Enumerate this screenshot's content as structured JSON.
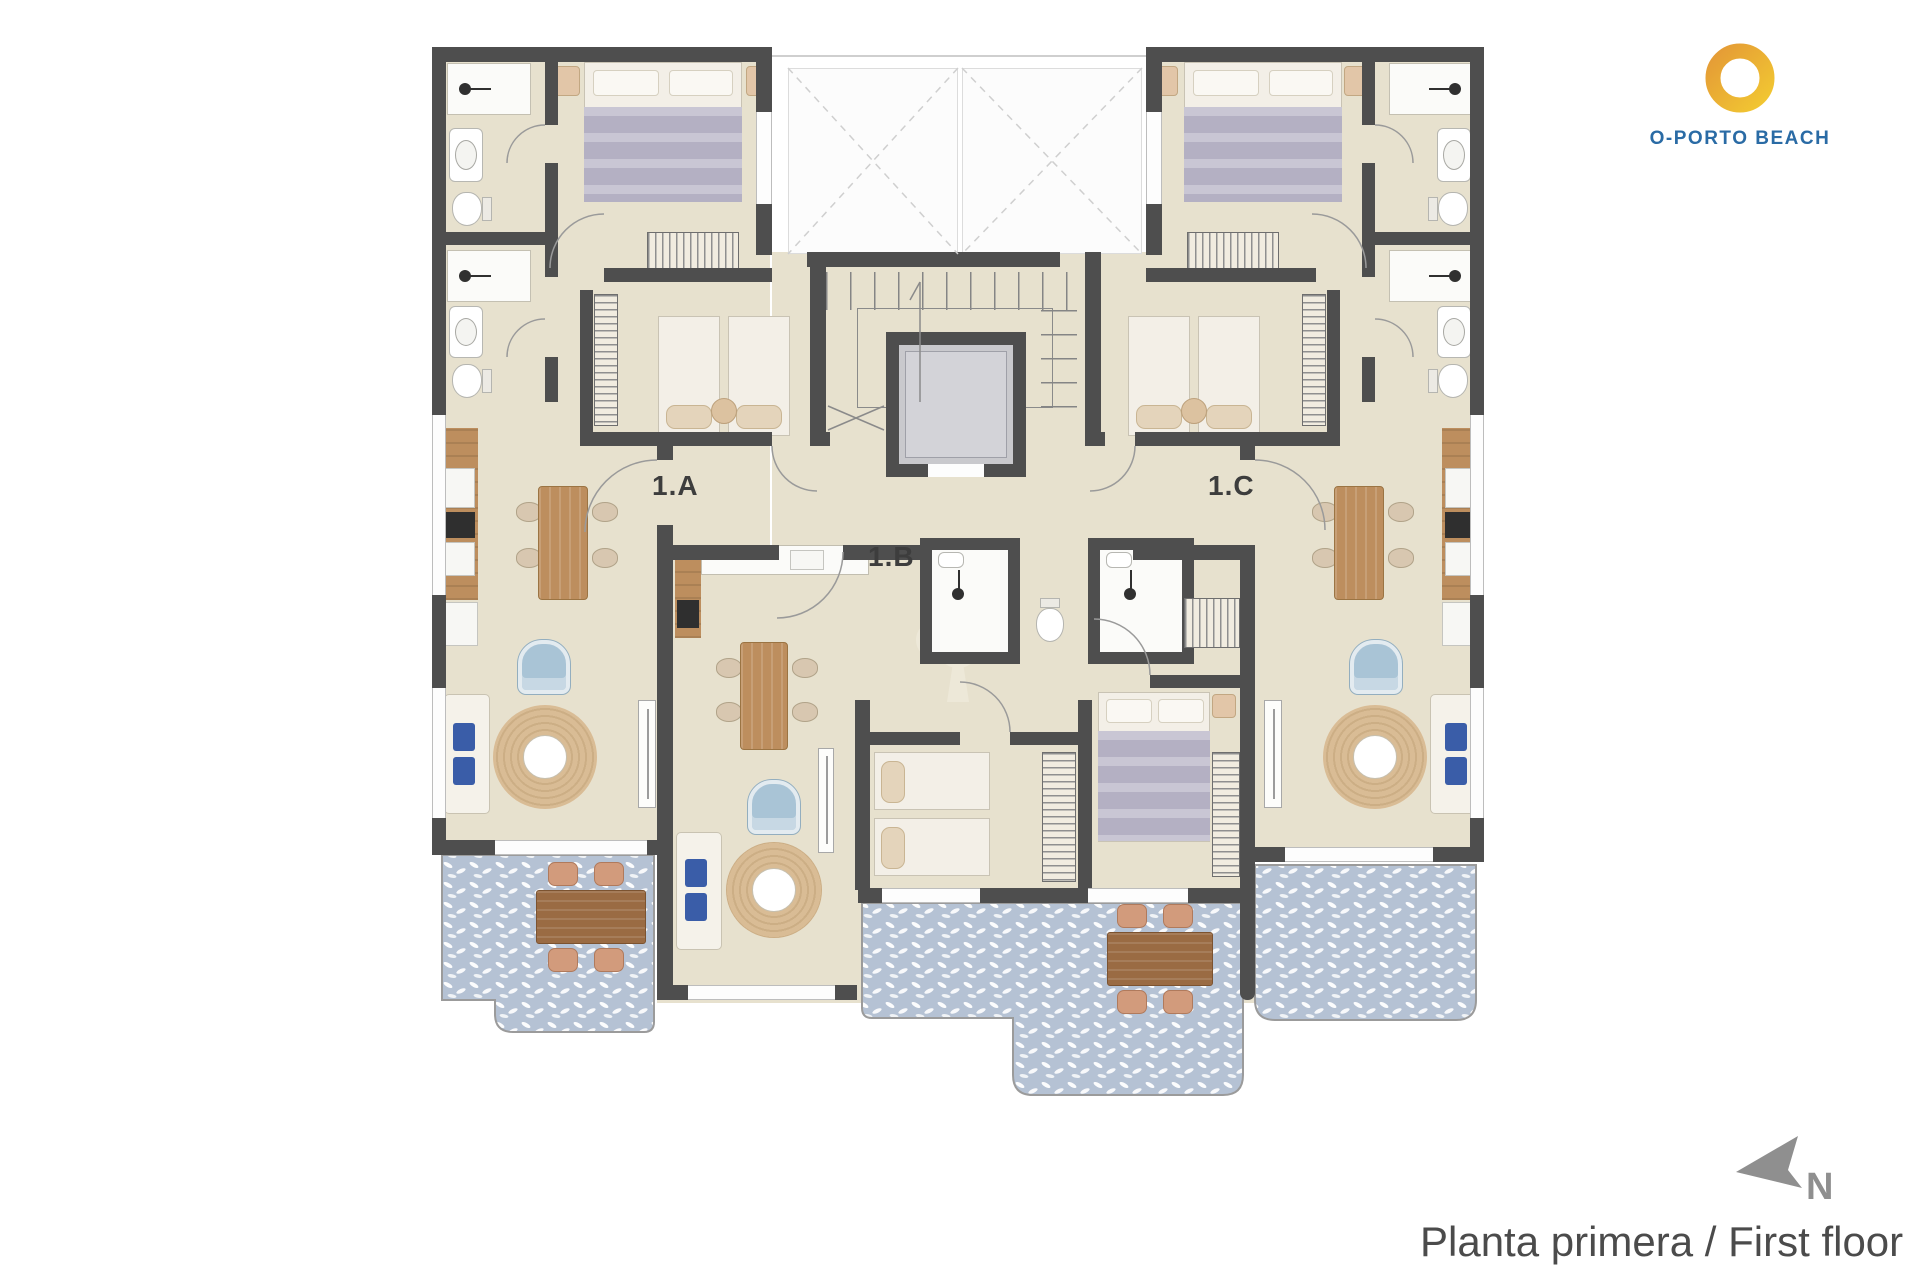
{
  "page": {
    "width": 1920,
    "height": 1280,
    "background": "#FFFFFF"
  },
  "logo": {
    "text": "O-PORTO BEACH"
  },
  "plan": {
    "units": [
      {
        "id": "1A",
        "label": "1.A"
      },
      {
        "id": "1B",
        "label": "1.B"
      },
      {
        "id": "1C",
        "label": "1.C"
      }
    ],
    "colors": {
      "wall": "#4E4E4E",
      "floor": "#E7E1CE",
      "terrace": "#B5C2D4",
      "wood": "#BD8E5E",
      "wood_dark": "#9A6B43",
      "bed_gray": "#B4B0C3",
      "rug": "#D9BC95",
      "chair_tan": "#D8C7B0",
      "chair_terra": "#D29B7C",
      "armchair": "#A9C4D6",
      "cushion": "#3A5DA8",
      "logo_blue": "#2A6BA5",
      "logo_yellow": "#F2C832",
      "logo_orange": "#E49A36",
      "caption_color": "#4B4B4B",
      "compass_color": "#8F8F8F",
      "label_color": "#3D3D3D"
    }
  },
  "compass": {
    "label": "N"
  },
  "caption": {
    "text": "Planta primera / First floor"
  }
}
